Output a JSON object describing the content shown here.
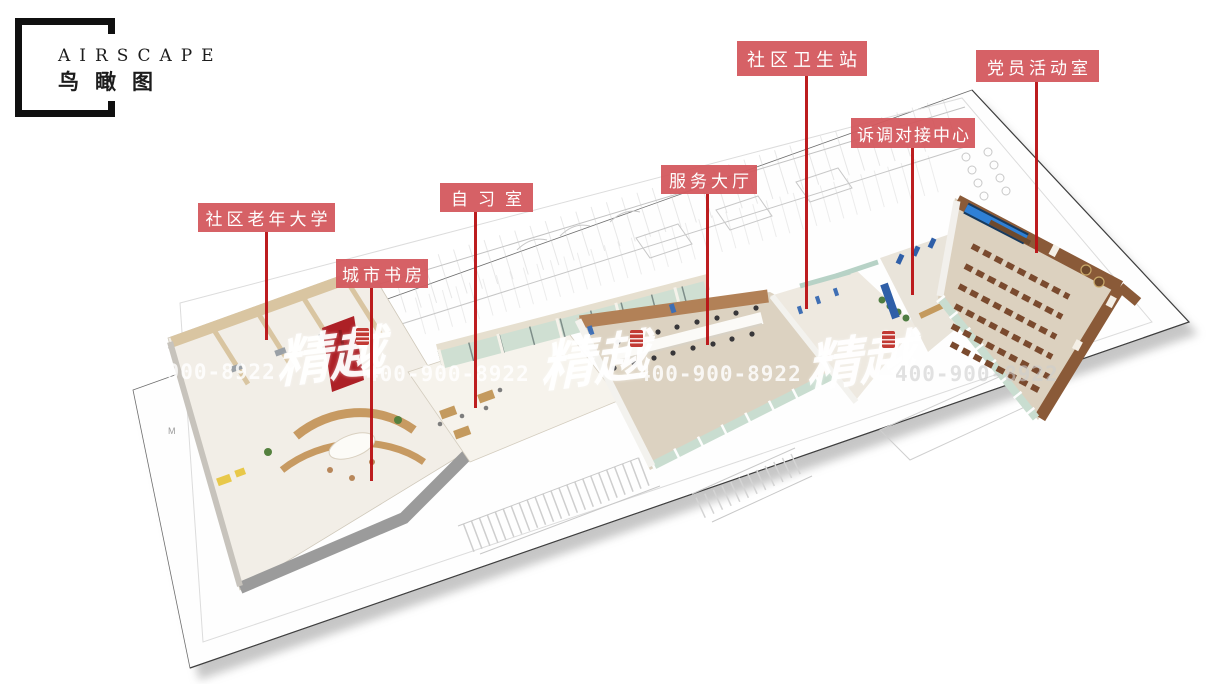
{
  "title_block": {
    "title": "AIRSCAPE",
    "subtitle": "鸟瞰图"
  },
  "annotations": {
    "labels": [
      {
        "id": "community-senior-university",
        "text": "社区老年大学"
      },
      {
        "id": "city-study",
        "text": "城市书房"
      },
      {
        "id": "self-study-room",
        "text": "自习室"
      },
      {
        "id": "service-hall",
        "text": "服务大厅"
      },
      {
        "id": "community-health-station",
        "text": "社区卫生站"
      },
      {
        "id": "mediation-center",
        "text": "诉调对接中心"
      },
      {
        "id": "party-activity-room",
        "text": "党员活动室"
      }
    ],
    "label_bg": "#d4595e",
    "leader_color": "#b91114"
  },
  "watermark": {
    "brand": "精越",
    "phone": "400-900-8922",
    "seal_icon": "red-seal-stamp-icon"
  },
  "plan": {
    "mark_m": "M",
    "colors": {
      "sheet": "#ffffff",
      "beige_wall": "#d9c5a1",
      "wood_wall": "#b28157",
      "party_wall": "#8a5a38",
      "front_wall_gray": "#9b9b9b",
      "screen_blue": "#2a6cc8",
      "kiosk_blue": "#3f6fb4",
      "accent_red": "#ad2026",
      "glass_green": "#c9ddd0",
      "floor_tan": "#dcd2c1"
    }
  }
}
